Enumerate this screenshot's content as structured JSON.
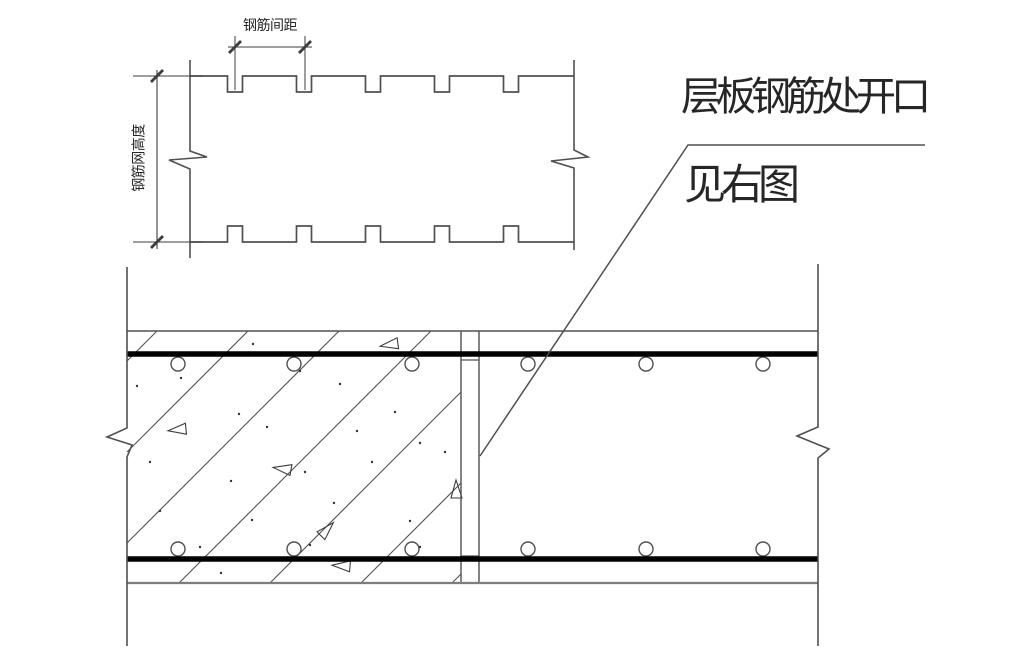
{
  "labels": {
    "spacing": "钢筋间距",
    "mesh_height": "钢筋网高度",
    "callout_line1": "层板钢筋处开口",
    "callout_line2": "见右图"
  },
  "colors": {
    "line": "#3d3d3d",
    "soft": "#505050",
    "gray": "#7d7d7d",
    "black": "#000000",
    "dot": "#333333",
    "bg": "#ffffff"
  },
  "drawing": {
    "template": {
      "top_y": 76,
      "bottom_y": 242,
      "left_x": 190,
      "right_x": 574,
      "notch_centers": [
        235,
        304,
        373,
        442,
        511
      ],
      "notch_half_w": 7.5,
      "notch_depth": 16,
      "left_polyline": [
        [
          190,
          60
        ],
        [
          190,
          151
        ],
        [
          207,
          157
        ],
        [
          169,
          160
        ],
        [
          190,
          169
        ],
        [
          190,
          258
        ]
      ],
      "right_polyline": [
        [
          574,
          60
        ],
        [
          574,
          150
        ],
        [
          588,
          157
        ],
        [
          551,
          161
        ],
        [
          574,
          168
        ],
        [
          574,
          250
        ]
      ],
      "dim_spacing": {
        "line": [
          [
            228,
            47
          ],
          [
            312,
            47
          ]
        ],
        "ticks": [
          [
            235,
            47
          ],
          [
            305,
            47
          ]
        ],
        "ext": [
          [
            [
              235,
              36
            ],
            [
              235,
              90
            ]
          ],
          [
            [
              305,
              36
            ],
            [
              305,
              90
            ]
          ]
        ]
      },
      "dim_height": {
        "line": [
          [
            157,
            70
          ],
          [
            157,
            249
          ]
        ],
        "ticks": [
          [
            157,
            76
          ],
          [
            157,
            242
          ]
        ],
        "ext": [
          [
            [
              133,
              76
            ],
            [
              203,
              76
            ]
          ],
          [
            [
              133,
              242
            ],
            [
              203,
              242
            ]
          ]
        ]
      }
    },
    "section": {
      "left_x": 127,
      "right_x": 818,
      "slab_top": 331,
      "slab_bottom": 583,
      "left_polyline": [
        [
          127,
          267
        ],
        [
          127,
          428
        ],
        [
          107,
          437
        ],
        [
          132,
          445
        ],
        [
          127,
          457
        ],
        [
          127,
          646
        ]
      ],
      "right_polyline": [
        [
          818,
          264
        ],
        [
          818,
          427
        ],
        [
          797,
          436
        ],
        [
          829,
          449
        ],
        [
          818,
          458
        ],
        [
          818,
          646
        ]
      ],
      "bars": [
        {
          "y": 354,
          "x1": 127,
          "x2": 818
        },
        {
          "y": 559,
          "x1": 127,
          "x2": 818
        }
      ],
      "bar_width": 5.5,
      "joint": {
        "x1": 461,
        "x2": 479,
        "y1": 331,
        "y2": 583,
        "conn_y": [
          360,
          556
        ]
      },
      "circles": {
        "r": 7,
        "top_y": 364,
        "bottom_y": 549,
        "xs": [
          178,
          294,
          412,
          528,
          646,
          763
        ]
      },
      "hatch": {
        "y1": 331,
        "y2": 583,
        "clip_x1": 127,
        "clip_x2": 461,
        "tops": [
          157,
          248,
          339,
          431,
          522,
          613,
          704
        ]
      },
      "triangles": [
        {
          "x": 389,
          "y": 345,
          "rot": -8
        },
        {
          "x": 177,
          "y": 430,
          "rot": -5
        },
        {
          "x": 282,
          "y": 469,
          "rot": 10
        },
        {
          "x": 327,
          "y": 529,
          "rot": 135
        },
        {
          "x": 341,
          "y": 566,
          "rot": 5
        },
        {
          "x": 456,
          "y": 489,
          "rot": 90
        }
      ],
      "dots": [
        [
          137,
          386
        ],
        [
          181,
          378
        ],
        [
          253,
          344
        ],
        [
          300,
          371
        ],
        [
          340,
          384
        ],
        [
          239,
          414
        ],
        [
          357,
          431
        ],
        [
          150,
          462
        ],
        [
          231,
          481
        ],
        [
          305,
          472
        ],
        [
          372,
          462
        ],
        [
          420,
          443
        ],
        [
          160,
          511
        ],
        [
          252,
          520
        ],
        [
          334,
          503
        ],
        [
          410,
          521
        ],
        [
          200,
          547
        ],
        [
          420,
          547
        ],
        [
          445,
          452
        ],
        [
          221,
          573
        ],
        [
          395,
          412
        ],
        [
          267,
          427
        ],
        [
          310,
          545
        ],
        [
          348,
          558
        ]
      ]
    },
    "callout": {
      "path": [
        [
          925,
          145
        ],
        [
          688,
          145
        ],
        [
          480,
          456
        ]
      ]
    }
  }
}
